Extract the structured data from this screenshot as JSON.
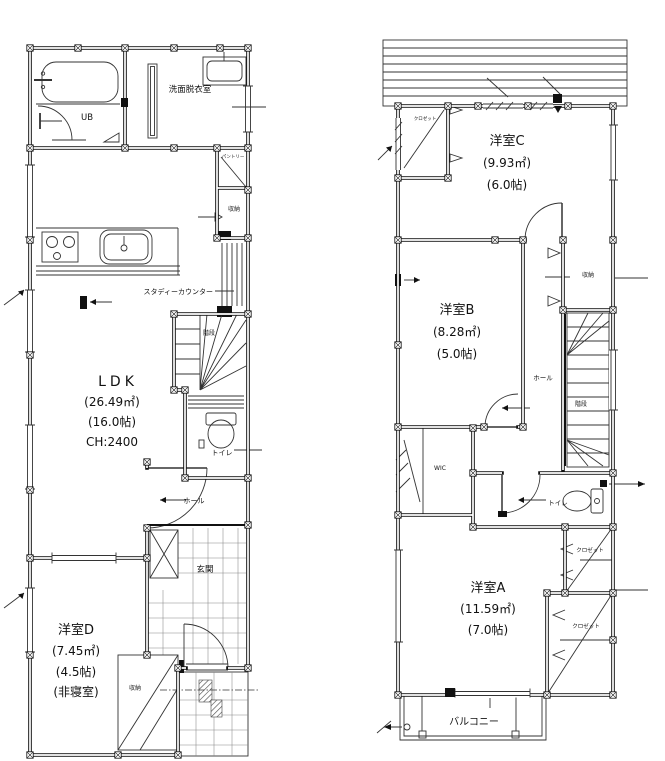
{
  "floor1": {
    "ub_label": "UB",
    "washroom_label": "洗面脱衣室",
    "pantry_label": "パントリー",
    "hall_storage_label": "収納",
    "study_counter_label": "スタディーカウンター",
    "stairs_label": "階段",
    "toilet_label": "トイレ",
    "hall_label": "ホール",
    "entrance_label": "玄関",
    "ldk": {
      "name": "LDK",
      "area_sqm": "(26.49㎡)",
      "area_jo": "(16.0帖)",
      "ceiling_height": "CH:2400"
    },
    "room_d": {
      "name": "洋室D",
      "area_sqm": "(7.45㎡)",
      "area_jo": "(4.5帖)",
      "note": "(非寝室)"
    },
    "room_d_storage_label": "収納"
  },
  "floor2": {
    "room_c": {
      "name": "洋室C",
      "area_sqm": "(9.93㎡)",
      "area_jo": "(6.0帖)"
    },
    "room_b": {
      "name": "洋室B",
      "area_sqm": "(8.28㎡)",
      "area_jo": "(5.0帖)"
    },
    "room_a": {
      "name": "洋室A",
      "area_sqm": "(11.59㎡)",
      "area_jo": "(7.0帖)"
    },
    "closet_c_label": "クロゼット",
    "storage_label": "収納",
    "hall_label": "ホール",
    "stairs_label": "階段",
    "wic_label": "WIC",
    "toilet_label": "トイレ",
    "closet_a_upper_label": "クロゼット",
    "closet_a_lower_label": "クロゼット",
    "balcony_label": "バルコニー"
  },
  "colors": {
    "line": "#111111",
    "background": "#ffffff"
  }
}
